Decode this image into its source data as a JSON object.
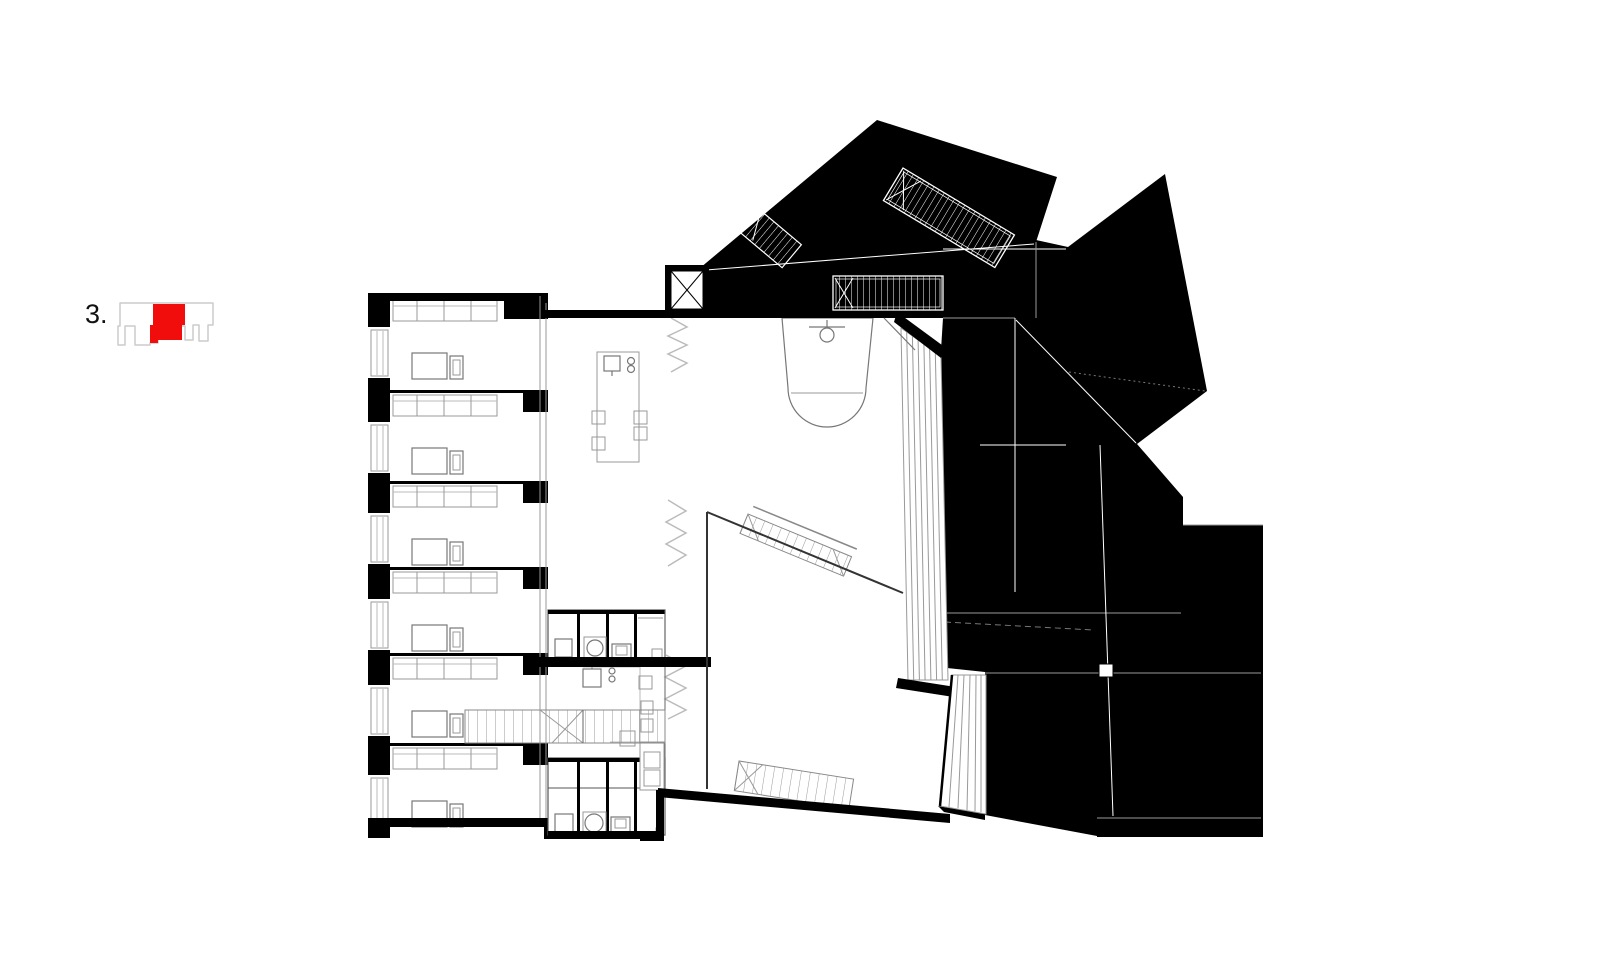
{
  "figure": {
    "label": "3."
  },
  "colors": {
    "ink": "#000000",
    "accent_red": "#f20d0d",
    "wall_gray": "#888888",
    "light_gray": "#cccccc"
  },
  "plan_summary": {
    "bedroom_modules": 6,
    "skylights": 3,
    "stair_flights": 3,
    "bathroom_rows": 2,
    "bathroom_cells_per_row": 4,
    "kitchen_islands": 2,
    "bathtubs": 1,
    "shafts": 1,
    "void_break_symbols": 3
  }
}
